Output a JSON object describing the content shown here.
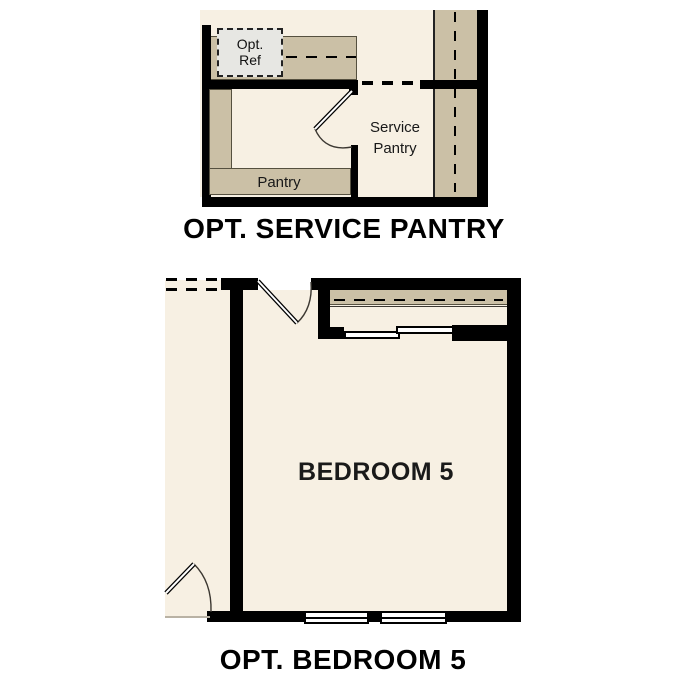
{
  "colors": {
    "floor": "#f7f0e3",
    "counter": "#cbc0a6",
    "wall": "#000000",
    "fridge": "#e7e7e3",
    "ink": "#111111",
    "outline": "#55503f"
  },
  "service_pantry_plan": {
    "title": "OPT. SERVICE PANTRY",
    "opt_ref": {
      "line1": "Opt.",
      "line2": "Ref"
    },
    "pantry_label": "Pantry",
    "service_pantry_label": {
      "line1": "Service",
      "line2": "Pantry"
    }
  },
  "bedroom_plan": {
    "title": "OPT. BEDROOM 5",
    "bedroom_label": "BEDROOM 5"
  }
}
